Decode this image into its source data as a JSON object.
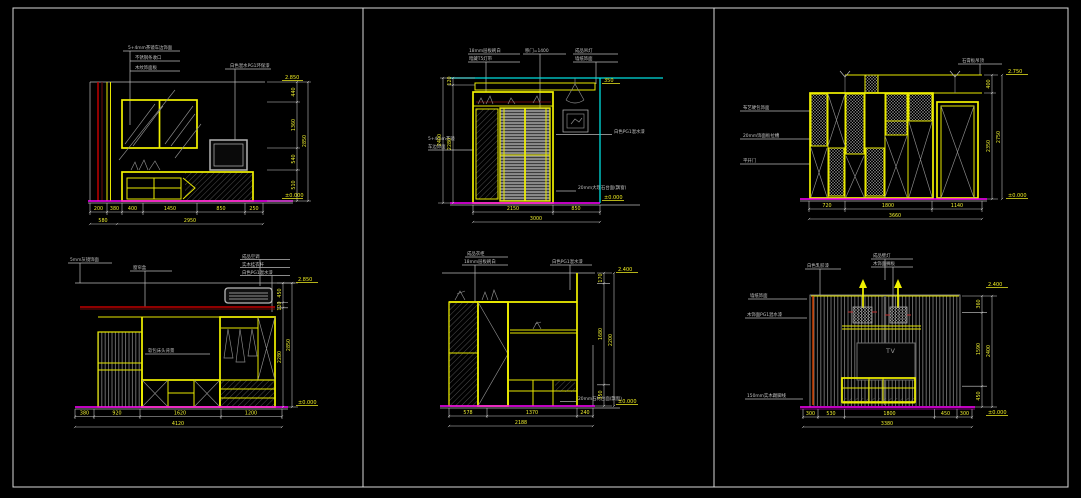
{
  "sheet": {
    "background": "#000000",
    "border_color": "#b9b9b9",
    "line_yellow": "#f2f200",
    "floor_magenta": "#ff00ff",
    "ceiling_cyan": "#00dede",
    "curtain_red": "#c00000",
    "dim_text_color": "#ecec30",
    "annotation_color": "#c2c2c2"
  },
  "panels": [
    {
      "ann": [
        "5+4mm茶镜车边饰面",
        "不锈钢条收口",
        "木纹饰面板",
        "白色混水PG1环保漆"
      ],
      "db1": [
        "200",
        "380",
        "400",
        "1450",
        "850",
        "250"
      ],
      "db2": [
        "580",
        "2950"
      ],
      "dv": [
        "440",
        "1360",
        "540",
        "510"
      ],
      "dvt": "2850",
      "et": "2.850",
      "eb": "±0.000"
    },
    {
      "ann": [
        "18mm层板刷白",
        "暗藏T5灯带",
        "移门=1400",
        "成品吊灯",
        "墙纸饰面",
        "5+4mm茶镜",
        "车边饰面",
        "白色PG1混水漆",
        "20mm大理石台面(飘窗)"
      ],
      "db1": [
        "2150",
        "850"
      ],
      "db2": [
        "3000"
      ],
      "dv": [
        "120",
        "2280"
      ],
      "dvt": "2400",
      "et": "350",
      "eb": "±0.000"
    },
    {
      "ann": [
        "石膏板吊顶",
        "布艺硬包饰面",
        "20mm饰面板拉槽",
        "平开门"
      ],
      "db1": [
        "720",
        "1800",
        "1140"
      ],
      "db2": [
        "3660"
      ],
      "dv": [
        "400",
        "2350"
      ],
      "dvt": "2750",
      "et": "2.750",
      "eb": "±0.000"
    },
    {
      "ann": [
        "5mm灰镜饰面",
        "窗帘盒",
        "成品空调",
        "实木挂衣杆",
        "白色PG1混水漆",
        "软包床头背景"
      ],
      "db1": [
        "380",
        "920",
        "1620",
        "1200"
      ],
      "db2": [
        "4120"
      ],
      "dv": [
        "450",
        "120",
        "2280"
      ],
      "dvt": "2850",
      "et": "2.850",
      "eb": "±0.000"
    },
    {
      "ann": [
        "成品衣柜",
        "18mm层板刷白",
        "白色PG1混水漆",
        "20mm石材台面(飘窗)"
      ],
      "db1": [
        "578",
        "1370",
        "240"
      ],
      "db2": [
        "2188"
      ],
      "dv": [
        "170",
        "1680",
        "350"
      ],
      "dvt": "2200",
      "et": "2.400",
      "eb": "±0.000"
    },
    {
      "ann": [
        "白色乳胶漆",
        "成品壁灯",
        "木饰面搁板",
        "墙纸饰面",
        "木饰面PG1混水漆",
        "150mm实木踢脚线"
      ],
      "tv": "TV",
      "db1": [
        "300",
        "530",
        "1800",
        "450",
        "300"
      ],
      "db2": [
        "3380"
      ],
      "dv": [
        "360",
        "1590",
        "450"
      ],
      "dvt": "2400",
      "et": "2.400",
      "eb": "±0.000"
    }
  ]
}
